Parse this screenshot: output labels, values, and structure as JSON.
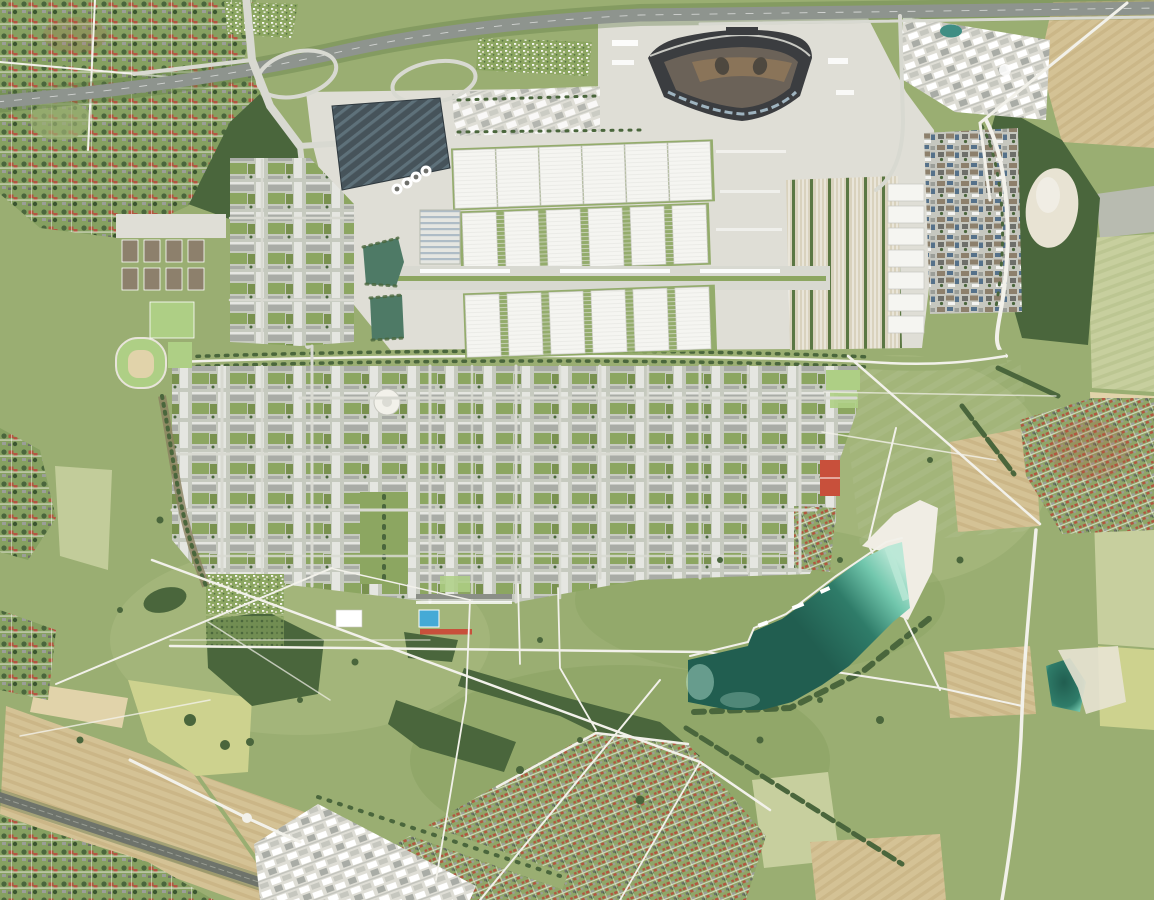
{
  "scene": {
    "type": "aerial-orthophoto",
    "description": "Vertical aerial photograph of a planned city district: trade-fair exhibition halls with a dark fan-shaped hall by a motorway in the north, a dense residential grid with green courtyards in the middle, a large landscape park with diagonal white paths and a turquoise bathing lake with white beach in the south, ringed by farm fields, woods, suburbs, a gravel works, a village, a business park and a railway line.",
    "no_visible_text": true
  },
  "features": [
    {
      "id": "motorway",
      "label": "motorway with interchange loops (top)"
    },
    {
      "id": "fan-hall",
      "label": "dark fan-shaped hall with brown inner courtyards"
    },
    {
      "id": "exhibition-halls",
      "label": "three rows of white exhibition halls"
    },
    {
      "id": "central-spine",
      "label": "glass-roofed pedestrian spine between hall rows"
    },
    {
      "id": "solar-deck",
      "label": "dark striped rooftop (solar car park)"
    },
    {
      "id": "round-tanks",
      "label": "four white circular tanks"
    },
    {
      "id": "retention-ponds",
      "label": "two green retention ponds"
    },
    {
      "id": "housing-grid",
      "label": "residential block grid with green roofs and courtyards"
    },
    {
      "id": "circular-plaza",
      "label": "white circular plaza"
    },
    {
      "id": "green-axis",
      "label": "green axis through housing"
    },
    {
      "id": "landscape-park",
      "label": "landscape park with crossing white paths"
    },
    {
      "id": "bathing-lake",
      "label": "turquoise bathing lake with white beach"
    },
    {
      "id": "allotments",
      "label": "allotment garden colonies"
    },
    {
      "id": "sports-fields",
      "label": "bright green sports pitches, blue pool, red track"
    },
    {
      "id": "village",
      "label": "red-roofed village (east)"
    },
    {
      "id": "suburbs",
      "label": "suburban housing (north-west, south, south-west)"
    },
    {
      "id": "fields",
      "label": "tan and pale-green farm fields"
    },
    {
      "id": "gravel-works",
      "label": "white gravel works (north-east)"
    },
    {
      "id": "railway",
      "label": "railway corridor (south-west)"
    }
  ],
  "exhibition_halls": {
    "row1_count": 6,
    "row2_count": 6,
    "row3_count": 6
  },
  "round_tank_count": 4,
  "palette": {
    "base_lawn": "#9aae72",
    "park_meadow_light": "#abbc82",
    "park_meadow_dark": "#849e5c",
    "forest": "#4a663c",
    "forest_dark": "#3a5530",
    "hedge": "#5b7743",
    "suburb_base": "#86a061",
    "suburb_base2": "#8fa668",
    "field_tan": "#d4c295",
    "field_tan_light": "#e1d3aa",
    "field_tan_dark": "#c2ac7c",
    "field_pale_green": "#c7cf9e",
    "field_pale_green_dark": "#b4bf8a",
    "field_yellow_green": "#cdd28e",
    "field_gray": "#b8bbb0",
    "sand": "#e8e3d3",
    "beach_white": "#f0ede4",
    "road_white": "#f2f1ea",
    "road_light": "#d8d9d1",
    "asphalt": "#9ba19b",
    "autobahn": "#8e948e",
    "concrete": "#dfded6",
    "concrete_dark": "#c6c7bf",
    "hall_white": "#f5f5f1",
    "hall_shadow": "#c3c6c0",
    "rib_line": "#e4e5e0",
    "fan_dark": "#3b3d40",
    "fan_mid": "#6b6258",
    "fan_brown": "#8a7459",
    "fan_inner_dark": "#4e483f",
    "skylight_blue": "#9fb4c0",
    "parkdeck_dark": "#46535a",
    "parkdeck_stripe": "#5e717a",
    "treat_stripe": "#aebcc6",
    "water_pond": "#4e7a66",
    "lake_deep": "#215e50",
    "lake_mid": "#2f7c69",
    "lake_light": "#72c7ad",
    "lake_pale": "#bce8d7",
    "pool_blue": "#45aad6",
    "track_red": "#c8503b",
    "roof_red": "#b25640",
    "roof_gray": "#9b9e98",
    "roof_dark": "#6e6f6a",
    "roof_green": "#79914f",
    "roof_brown": "#8d806c",
    "biz_blue": "#55718a",
    "block_white": "#e5e6e1",
    "block_gray": "#a9aca6",
    "courtyard_green": "#8ca661",
    "housing_street": "#c6cabf",
    "parking_tan": "#d9d2bd",
    "rail_dark": "#6e736b",
    "pitch_green": "#aecf85",
    "white": "#ffffff"
  }
}
